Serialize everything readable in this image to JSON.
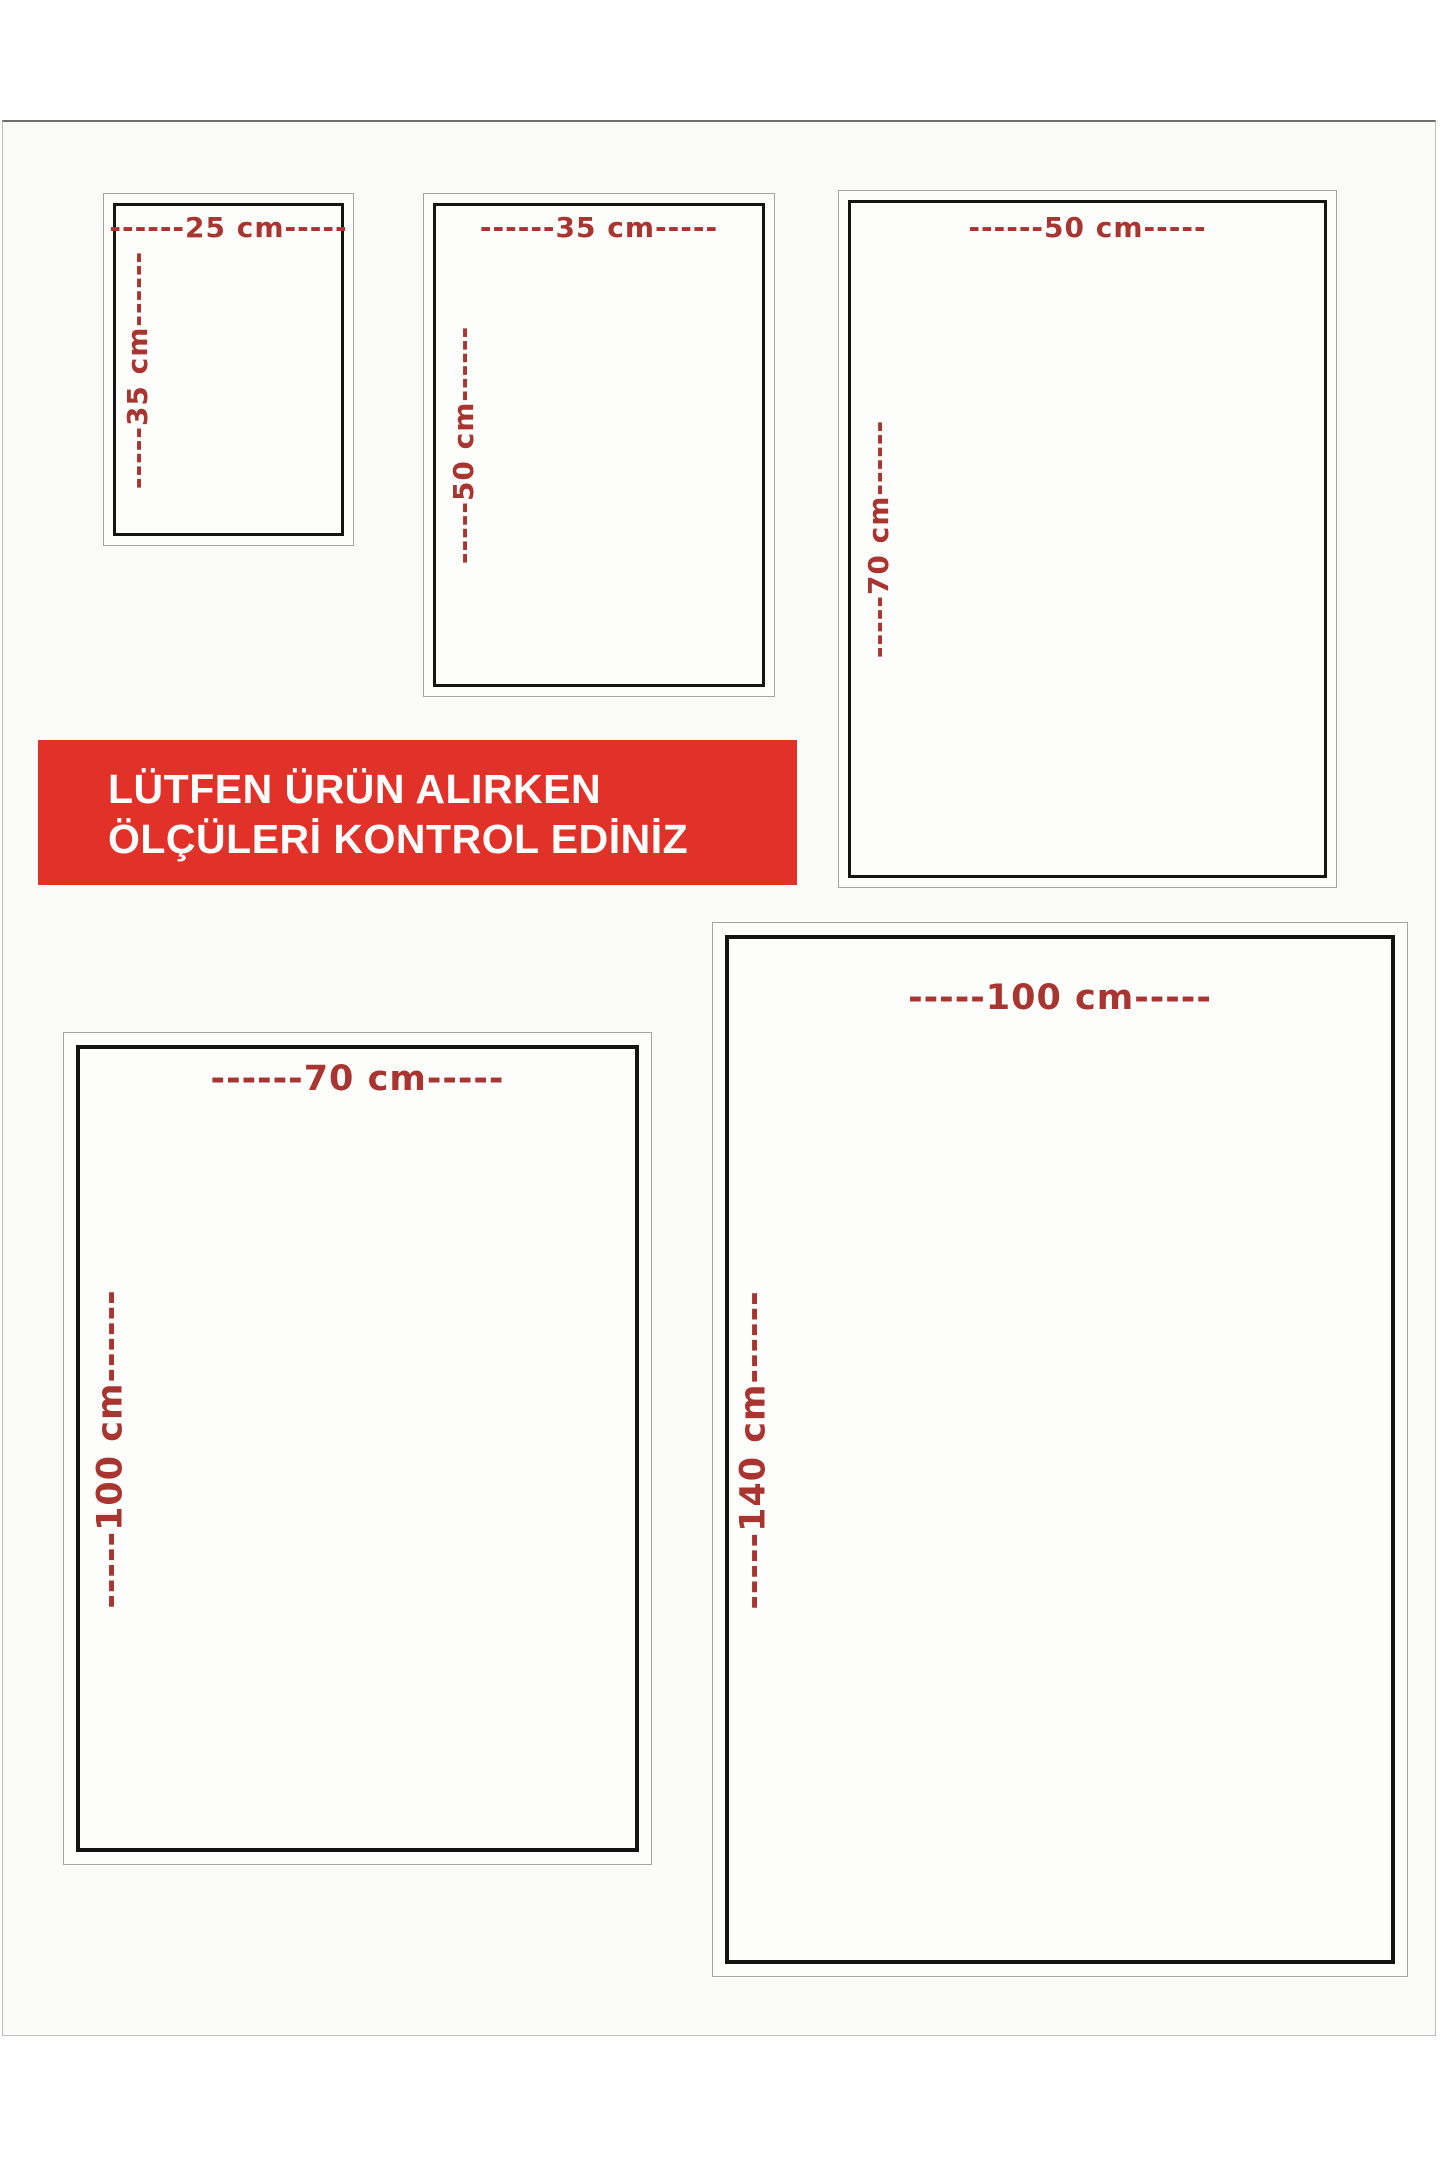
{
  "page": {
    "language": "tr",
    "description_visible_content": "Product size guide with five nested-border rectangles showing dimensions in cm and a red warning banner"
  },
  "notice_banner": {
    "line1": "LÜTFEN ÜRÜN ALIRKEN",
    "line2": "ÖLÇÜLERİ KONTROL EDİNİZ",
    "bg_color": "#e23128",
    "text_color": "#ffffff"
  },
  "label_color": "#a93530",
  "border_black": "#141414",
  "border_gray": "#a3a3a3",
  "boxes": [
    {
      "size": "25x35",
      "width_cm": 25,
      "height_cm": 35,
      "width_label": "------25 cm-----",
      "height_label": "-----35 cm------"
    },
    {
      "size": "35x50",
      "width_cm": 35,
      "height_cm": 50,
      "width_label": "------35 cm-----",
      "height_label": "-----50 cm------"
    },
    {
      "size": "50x70",
      "width_cm": 50,
      "height_cm": 70,
      "width_label": "------50 cm-----",
      "height_label": "-----70 cm------"
    },
    {
      "size": "70x100",
      "width_cm": 70,
      "height_cm": 100,
      "width_label": "------70 cm-----",
      "height_label": "-----100 cm------"
    },
    {
      "size": "100x140",
      "width_cm": 100,
      "height_cm": 140,
      "width_label": "-----100 cm-----",
      "height_label": "-----140 cm------"
    }
  ]
}
